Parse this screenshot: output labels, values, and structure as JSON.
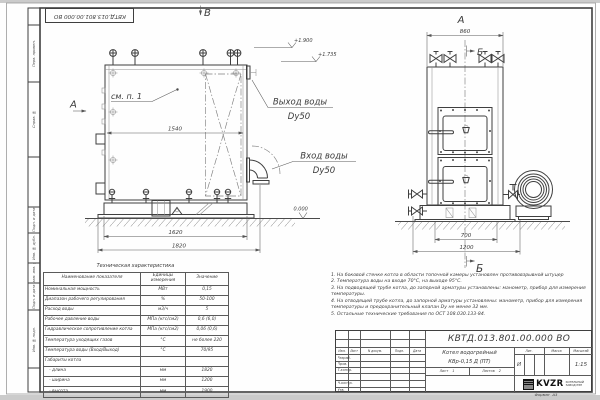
{
  "colors": {
    "paper": "#fefefe",
    "line_main": "#3f3f3f",
    "line_thin": "#8f8f8f",
    "edge_band": "#cbcbcb"
  },
  "stamp": {
    "code_inverted": "КВТД.013.801.00.000  ВО"
  },
  "frame": {
    "left_labels": [
      "Перв. примен.",
      "Справ. №",
      "Подп. и дата",
      "Инв. № дубл.",
      "Взам. инв. №",
      "Подп. и дата",
      "Инв. № подл."
    ]
  },
  "drawing": {
    "view_b_label": "В",
    "view_a_arrow_label": "А",
    "see_ref": "см. п. 1",
    "outlet_label": "Выход воды",
    "outlet_size": "Dy50",
    "inlet_label": "Вход воды",
    "inlet_size": "Dy50",
    "level_top": "+1.900",
    "level_mid": "+1.735",
    "level_zero": "0.000",
    "dim_inner_width": "1540",
    "dim_base_length": "1620",
    "dim_total_length": "1820",
    "right_view_label": "А",
    "section_top_label": "Б",
    "section_bottom_label": "Б",
    "dim_front_width": "860",
    "dim_front_base": "700",
    "dim_front_total": "1200"
  },
  "tech_table": {
    "title": "Техническая характеристика",
    "headers": [
      "Наименование показателя",
      "Единицы измерения",
      "Значение"
    ],
    "rows": [
      [
        "Номинальная мощность",
        "МВт",
        "0,15"
      ],
      [
        "Диапазон рабочего регулирования",
        "%",
        "50-100"
      ],
      [
        "Расход воды",
        "м3/ч",
        "5"
      ],
      [
        "Рабочее давление воды",
        "МПа (кгс/см2)",
        "0,6 (6,0)"
      ],
      [
        "Гидравлическое сопротивление котла",
        "МПа (кгс/см2)",
        "0,06 (0,6)"
      ],
      [
        "Температура уходящих газов",
        "°С",
        "не более 220"
      ],
      [
        "Температура воды (Вход/Выход)",
        "°С",
        "70/95"
      ],
      [
        "Габариты котла",
        "",
        ""
      ],
      [
        "   - длина",
        "мм",
        "1820"
      ],
      [
        "   - ширина",
        "мм",
        "1200"
      ],
      [
        "   - высота",
        "мм",
        "1900"
      ]
    ]
  },
  "notes": [
    "1. На боковой стенке котла в области топочной камеры установлен противовзрывной штуцер",
    "2. Температура воды на входе 70°С, на выходе 95°С.",
    "3. На подводящей трубе котла, до запорной арматуры установлены: манометр, прибор для измерения температуры.",
    "4. На отводящей трубе котла, до запорной арматуры установлены: манометр, прибор для измерения температуры и предохранительный клапан Dу не менее 32 мм.",
    "5. Остальные технические требования по ОСТ 108.030.133-84."
  ],
  "title_block": {
    "designation": "КВТД.013.801.00.000  ВО",
    "change_headers": [
      "Изм.",
      "Лист",
      "N докум.",
      "Подп.",
      "Дата"
    ],
    "roles": [
      "Разраб.",
      "Пров.",
      "Т.контр.",
      "Н.контр.",
      "Утв."
    ],
    "product_line1": "Котел водогрейный",
    "product_line2": "КВр-0,15  Д  (ПТ)",
    "lit_header": "Лит.",
    "lit_value": "И",
    "mass_header": "Масса",
    "scale_header": "Масштаб",
    "scale_value": "1:15",
    "sheet_label": "Лист",
    "sheet_value": "1",
    "sheets_label": "Листов",
    "sheets_value": "2",
    "company_logo": "KVZR",
    "company_line1": "КОТЕЛЬНЫЙ",
    "company_line2": "ЗАВОД РЭП",
    "format_label": "Формат",
    "format_value": "А3"
  }
}
